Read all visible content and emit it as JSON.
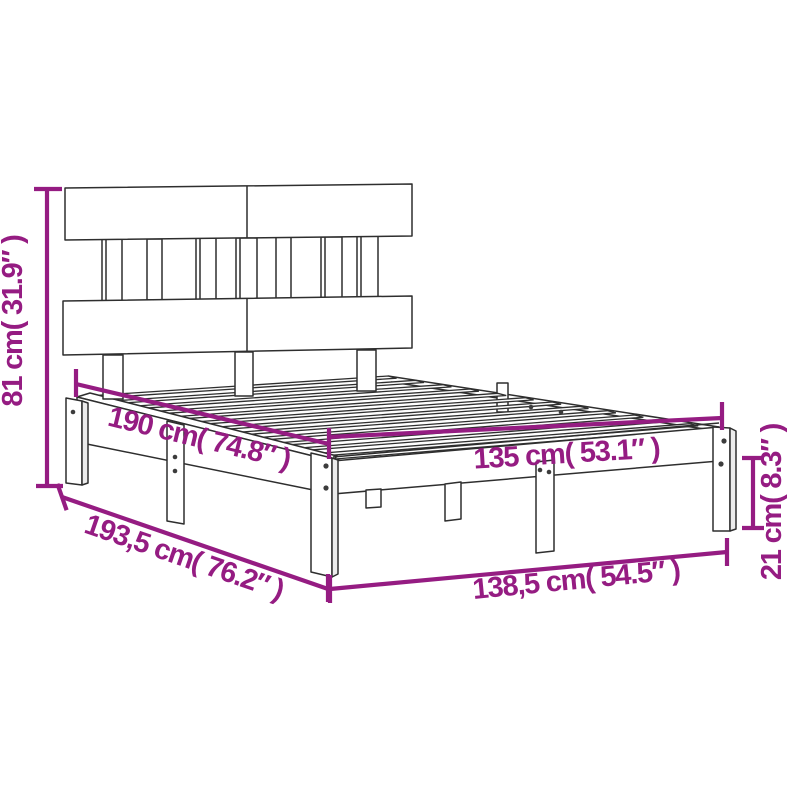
{
  "canvas": {
    "width": 800,
    "height": 800
  },
  "style": {
    "accent_color": "#951c82",
    "line_color": "#2e2e2e",
    "background": "#ffffff"
  },
  "diagram": {
    "type": "product-dimension-drawing",
    "subject": "bed-frame-with-headboard",
    "dimensions": {
      "headboard_height": {
        "label": "81 cm( 31.9″ )",
        "cm": "81",
        "inch": "31.9",
        "placement": "vertical-left"
      },
      "bed_length_inner": {
        "label": "190 cm( 74.8″ )",
        "cm": "190",
        "inch": "74.8",
        "placement": "along-side-rail"
      },
      "bed_width_inner": {
        "label": "135 cm( 53.1″ )",
        "cm": "135",
        "inch": "53.1",
        "placement": "along-foot-rail"
      },
      "frame_height": {
        "label": "21 cm( 8.3″ )",
        "cm": "21",
        "inch": "8.3",
        "placement": "vertical-right"
      },
      "frame_length_outer": {
        "label": "193,5 cm( 76.2″ )",
        "cm": "193,5",
        "inch": "76.2",
        "placement": "diagonal-bottom-left"
      },
      "frame_width_outer": {
        "label": "138,5 cm( 54.5″ )",
        "cm": "138,5",
        "inch": "54.5",
        "placement": "bottom"
      }
    }
  }
}
